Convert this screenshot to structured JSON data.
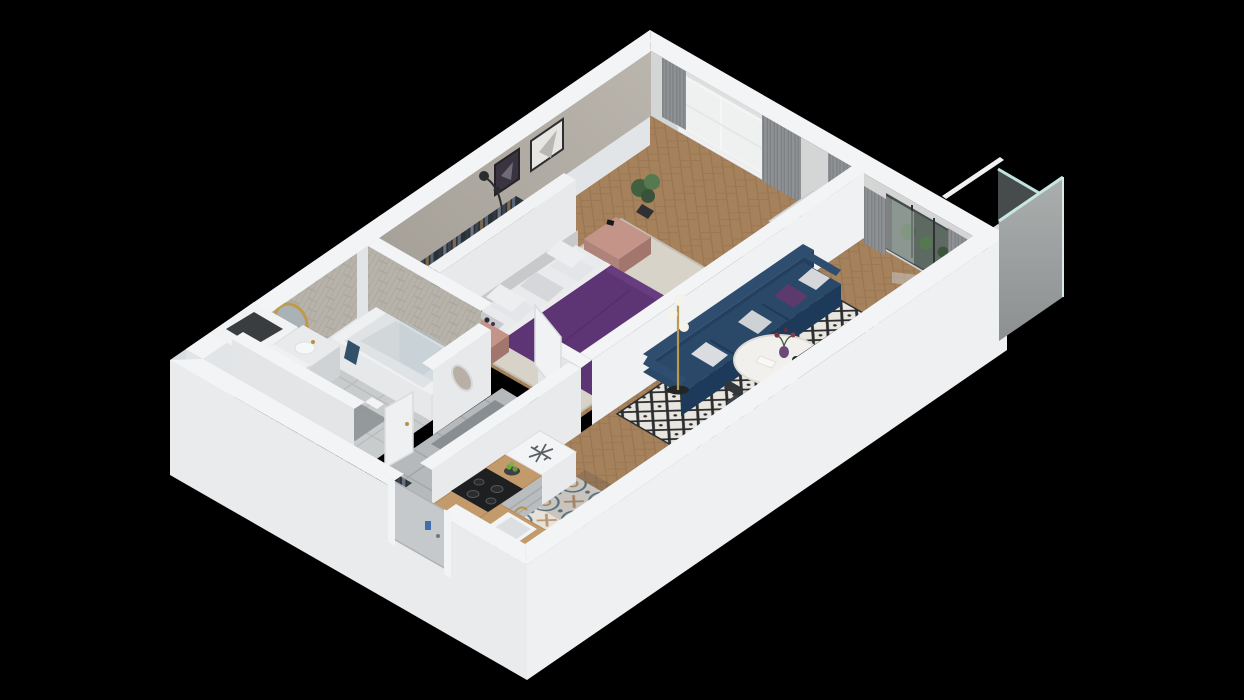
{
  "scene": {
    "background": "#000000",
    "description": "isometric-3d-cutaway-floor-plan-render-one-bedroom-apartment"
  },
  "colors": {
    "wall_top": "#f3f4f5",
    "wall_face_light": "#eceeef",
    "wall_face_shade": "#e0e3e5",
    "outer_face_nw": "#e2e5e7",
    "outer_face_s": "#e9ebed",
    "outer_face_se": "#eef0f1",
    "bedroom_wall": "#b2ada5",
    "ne_wall_face": "#d4d5d5",
    "parquet": "#a5815c",
    "rug_bedroom": "#d8d3c9",
    "rug_living_bg": "#e9e6df",
    "rug_living_pattern": "#2b2d30",
    "tile_gray": "#b6b9bb",
    "tile_bath": "#c9cccd",
    "tile_kitchen_bg": "#e6e2d8",
    "tile_kitchen_blue": "#5d7a8c",
    "tile_kitchen_tan": "#b99772",
    "bed_purple": "#5d3574",
    "sofa_navy": "#2a4868",
    "sofa_navy_dark": "#1d3a5a",
    "pillow_gray": "#d5d7da",
    "pillow_purple": "#5d3a6e",
    "nightstand_pink": "#c59489",
    "counter_wood": "#c29a6b",
    "cabinet_gray": "#b9bdbf",
    "curtain_gray": "#8f9295",
    "tv_black": "#17191b",
    "gold": "#b8923f",
    "glass_teal": "#bfe3de",
    "panel_concrete": "#9aa0a1",
    "plant_green": "#4e7248",
    "apple_green": "#71a844",
    "washer_door": "#2c4a63",
    "door_gray": "#c6c9cb",
    "rack_dark": "#27292c"
  },
  "icons": {
    "freezer_icon": "snowflake"
  },
  "rooms": [
    {
      "id": "bedroom",
      "furniture": [
        "double-bed",
        "pillows",
        "nightstand-clock",
        "nightstand-plant",
        "desk",
        "desk-chair",
        "tv",
        "floor-lamp",
        "open-clothes-rack",
        "plant",
        "wall-art",
        "window",
        "curtains"
      ]
    },
    {
      "id": "living-room",
      "furniture": [
        "navy-sofa",
        "sofa-pillows",
        "coffee-table",
        "globe-floor-lamp",
        "tv",
        "patterned-rug",
        "dining-chairs",
        "balcony-door",
        "curtains"
      ]
    },
    {
      "id": "kitchen",
      "furniture": [
        "fridge-snowflake-top",
        "cooktop",
        "sink",
        "l-shaped-counter",
        "fruit-bowl"
      ]
    },
    {
      "id": "bathroom",
      "furniture": [
        "bathtub",
        "vanity-sink",
        "round-gold-mirror",
        "washing-machine",
        "towel",
        "herringbone-wall-tiles"
      ]
    },
    {
      "id": "hallway",
      "furniture": [
        "open-clothes-rack",
        "entrance-door",
        "doormat",
        "bathroom-door",
        "arched-mirror"
      ]
    },
    {
      "id": "balcony",
      "furniture": [
        "planters",
        "glass-railing",
        "concrete-privacy-panel",
        "tile-floor"
      ]
    }
  ]
}
